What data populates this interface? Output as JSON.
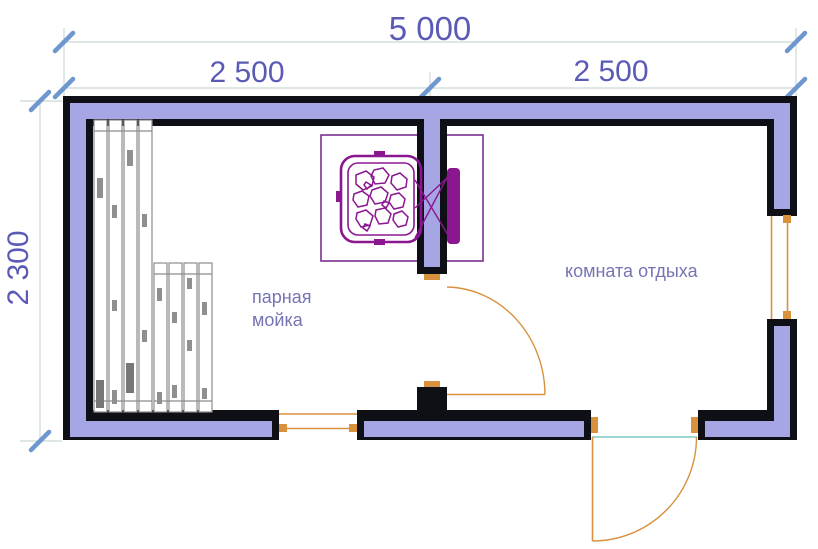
{
  "drawing": {
    "type": "sauna-floor-plan"
  },
  "dimensions": {
    "overall_width": "5 000",
    "left_section_width": "2 500",
    "right_section_width": "2 500",
    "overall_depth": "2 300"
  },
  "rooms": {
    "steam_wash_room": {
      "label_line1": "парная",
      "label_line2": "мойка"
    },
    "rest_room": {
      "label": "комната отдыха"
    }
  },
  "colors": {
    "background": "#ffffff",
    "wall_outline": "#0f0f16",
    "wall_fill": "#a6a6e4",
    "dimension_text": "#5b5bb7",
    "room_label": "#7474b4",
    "dimension_line": "#ccd8d8",
    "tick_mark": "#6f97cf",
    "joinery_orange": "#d8913d",
    "threshold_teal": "#7fccc3",
    "stove_magenta": "#8a1690",
    "enclosure_purple": "#7b2f8f",
    "bench_outline": "#8c8c8c"
  }
}
